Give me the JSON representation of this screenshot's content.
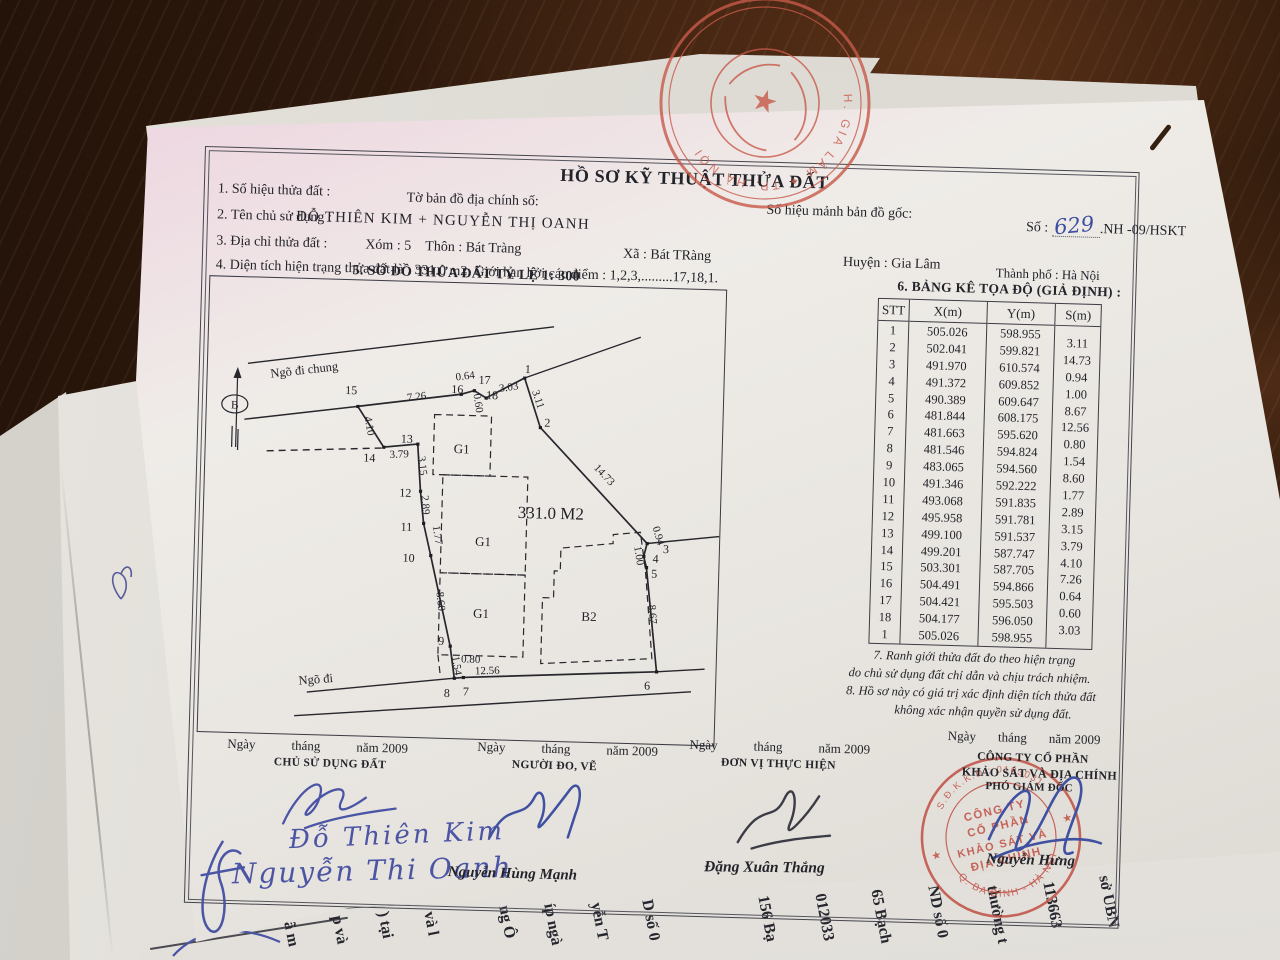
{
  "doc": {
    "title": "HỒ SƠ KỸ THUẬT THỬA ĐẤT",
    "row1": {
      "f1": "1. Số hiệu thửa đất :",
      "map": "Tờ bản đồ địa chính số:",
      "orig": "Số hiệu mảnh bản đồ gốc:",
      "so": "Số :",
      "so_hand": "629",
      "so_tail": ".NH -09/HSKT"
    },
    "row2": {
      "label": "2. Tên chủ sử dụng :",
      "value": "ĐỖ THIÊN KIM + NGUYỄN THỊ OANH"
    },
    "row3": {
      "label": "3. Địa chỉ thửa đất :",
      "xom": "Xóm : 5",
      "thon": "Thôn : Bát Tràng",
      "xa": "Xã : Bát TRàng",
      "huyen": "Huyện : Gia Lâm",
      "tp": "Thành phố : Hà Nội"
    },
    "row4": "4. Diện tích hiện trạng thửa đất là :  331.0  m2. Giới hạn bởi các điểm : 1,2,3,.........17,18,1.",
    "sec5": "5. SƠ ĐỒ THỬA ĐẤT  TỶ LỆ  1: 300",
    "sec6": "6. BẢNG KÊ TỌA ĐỘ (GIẢ ĐỊNH) :",
    "note7a": "7. Ranh giới thửa đất đo theo hiện trạng",
    "note7b": "do chủ sử dụng đất chỉ dẫn và chịu trách nhiệm.",
    "note8a": "8. Hồ sơ này có giá trị xác định diện tích thửa đất",
    "note8b": "không xác nhận quyền sử dụng đất."
  },
  "table": {
    "headers": [
      "STT",
      "X(m)",
      "Y(m)",
      "S(m)"
    ],
    "stt": [
      "1",
      "2",
      "3",
      "4",
      "5",
      "6",
      "7",
      "8",
      "9",
      "10",
      "11",
      "12",
      "13",
      "14",
      "15",
      "16",
      "17",
      "18",
      "1"
    ],
    "x": [
      "505.026",
      "502.041",
      "491.970",
      "491.372",
      "490.389",
      "481.844",
      "481.663",
      "481.546",
      "483.065",
      "491.346",
      "493.068",
      "495.958",
      "499.100",
      "499.201",
      "503.301",
      "504.491",
      "504.421",
      "504.177",
      "505.026"
    ],
    "y": [
      "598.955",
      "599.821",
      "610.574",
      "609.852",
      "609.647",
      "608.175",
      "595.620",
      "594.824",
      "594.560",
      "592.222",
      "591.835",
      "591.781",
      "591.537",
      "587.747",
      "587.705",
      "594.866",
      "595.503",
      "596.050",
      "598.955"
    ],
    "s": [
      "3.11",
      "14.73",
      "0.94",
      "1.00",
      "8.67",
      "12.56",
      "0.80",
      "1.54",
      "8.60",
      "1.77",
      "2.89",
      "3.15",
      "3.79",
      "4.10",
      "7.26",
      "0.64",
      "0.60",
      "3.03"
    ]
  },
  "diagram": {
    "north": "B",
    "area": "331.0 M2",
    "road_top": "Ngõ đi chung",
    "road_bottom": "Ngõ đi",
    "g1": "G1",
    "b2": "B2"
  },
  "sign": {
    "date": {
      "d": "Ngày",
      "m": "tháng",
      "y": "năm 2009"
    },
    "b1": {
      "role": "CHỦ SỬ DỤNG ĐẤT",
      "hand1": "Đỗ Thiên Kim",
      "hand2": "Nguyễn Thi Oanh"
    },
    "b2": {
      "role": "NGƯỜI ĐO, VẼ",
      "name": "Nguyễn Hùng Mạnh"
    },
    "b3": {
      "role": "ĐƠN VỊ THỰC HIỆN",
      "name": "Đặng Xuân Thắng"
    },
    "b4": {
      "l1": "CÔNG TY CỔ PHẦN",
      "l2": "KHẢO SÁT VÀ ĐỊA CHÍNH",
      "l3": "PHÓ GIÁM ĐỐC",
      "name": "Nguyễn Hưng"
    }
  },
  "stamp_bottom": {
    "ring_top": "S.Đ.K.K.D : 0103031",
    "c1": "CÔNG TY",
    "c2": "CỔ PHẦN",
    "c3": "KHẢO SÁT VÀ",
    "c4": "ĐỊA CHÍNH",
    "ring_bottom": "Q. BA ĐÌNH - HÀ NỘI",
    "star": "★",
    "color": "#bf4a3e"
  },
  "stamp_top": {
    "ring": "H. GIA LÂM  ✦  TP. HÀ NỘI",
    "star": "★",
    "color": "#c85a4a"
  },
  "under": {
    "fragments": [
      "sở UBN",
      "113663",
      "thường t",
      "ND số 0",
      "65 Bạch",
      "012033",
      "156 Bạ",
      "D số 0",
      "yễn T",
      "íp ngà",
      "ng Ô",
      "và l",
      ") tại",
      "p và",
      "ã m"
    ]
  }
}
